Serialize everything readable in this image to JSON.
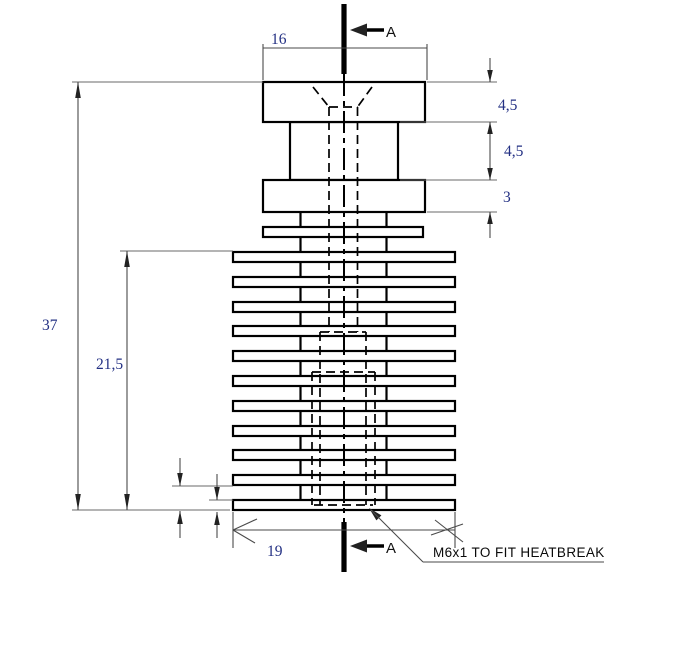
{
  "drawing": {
    "type": "technical-drawing",
    "part": "heatsink-section-view",
    "section_marker": "A",
    "dimensions": {
      "top_width": "16",
      "cap_height": "4,5",
      "neck_height": "4,5",
      "collar_height": "3",
      "overall_height": "37",
      "fin_stack_height": "21,5",
      "bottom_width": "19"
    },
    "annotation": {
      "thread_note": "M6x1 TO FIT HEATBREAK"
    },
    "colors": {
      "background": "#ffffff",
      "outline": "#000000",
      "dim_lines": "#4a4a4a",
      "dim_text": "#233083",
      "note_text": "#0a0a0a"
    }
  }
}
